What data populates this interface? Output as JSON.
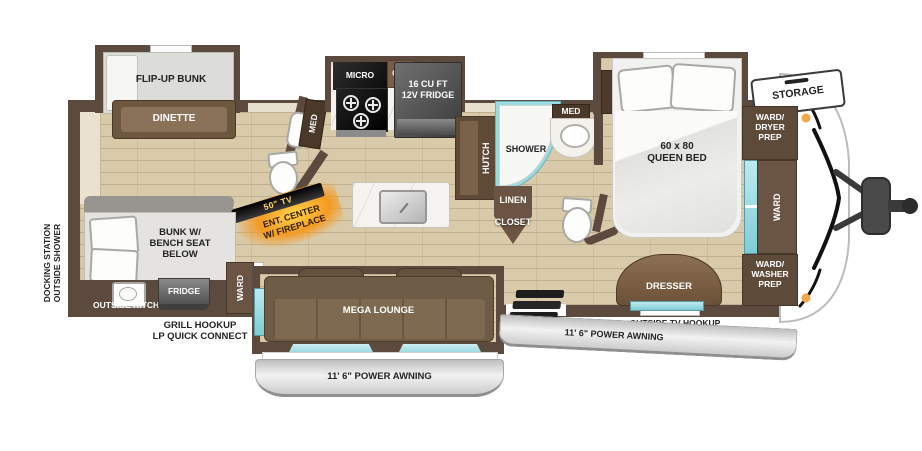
{
  "labels": {
    "flip_up_bunk": "FLIP-UP BUNK",
    "dinette": "DINETTE",
    "med_half_bath": "MED",
    "tv": "50\" TV",
    "ent_center": "ENT. CENTER\nW/ FIREPLACE",
    "micro": "MICRO",
    "ohc": "OHC",
    "fridge_12v": "16 CU FT\n12V FRIDGE",
    "hutch": "HUTCH",
    "shower": "SHOWER",
    "med_main_bath": "MED",
    "linen": "LINEN",
    "closet": "CLOSET",
    "queen_bed": "60 x 80\nQUEEN BED",
    "storage": "STORAGE",
    "ward_dryer_prep": "WARD/\nDRYER\nPREP",
    "ward_front": "WARD",
    "ward_washer_prep": "WARD/\nWASHER\nPREP",
    "dresser": "DRESSER",
    "outside_tv_hookup": "OUTSIDE TV HOOKUP",
    "power_awning_right": "11' 6\" POWER AWNING",
    "mega_lounge": "MEGA LOUNGE",
    "power_awning_bottom": "11' 6\" POWER AWNING",
    "ward_rear": "WARD",
    "outside_fridge": "FRIDGE",
    "outside_kitchen": "OUTSIDE KITCHEN",
    "bunk_bench": "BUNK W/\nBENCH SEAT\nBELOW",
    "grill_hookup": "GRILL HOOKUP\nLP QUICK CONNECT",
    "docking_station": "DOCKING STATION\nOUTSIDE SHOWER"
  },
  "colors": {
    "wall": "#5b4a3d",
    "floor": "#d9cbaa",
    "cabinet": "#6a5443",
    "counter_teal": "#7fcdd6",
    "sofa": "#7d6a50",
    "awning_gray": "#d6d6d6",
    "fireplace_glow": "#f59a23",
    "tv_text_yellow": "#ffd96a",
    "appliance_dark": "#3f3f3f",
    "exterior_text": "#1a1a1a"
  }
}
